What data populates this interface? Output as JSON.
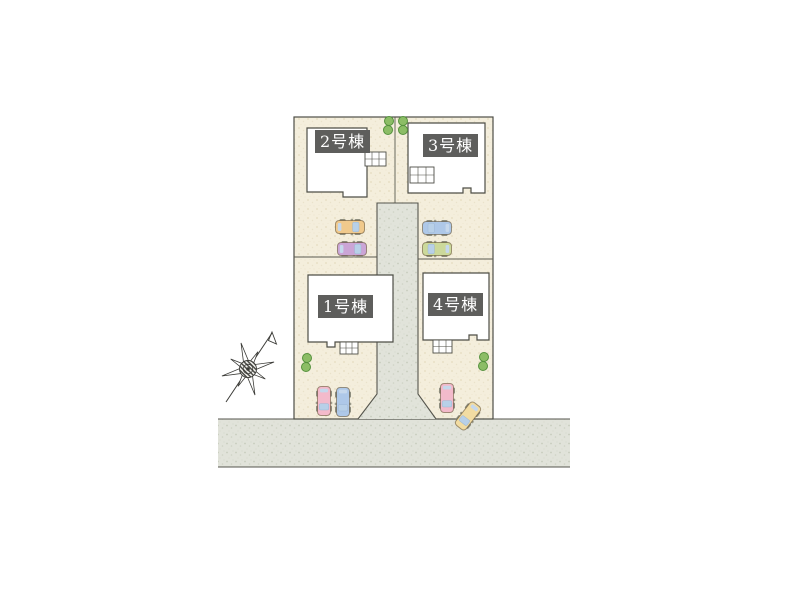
{
  "site_plan": {
    "type": "residential-lot-layout",
    "buildings": [
      {
        "label": "1号棟"
      },
      {
        "label": "2号棟"
      },
      {
        "label": "3号棟"
      },
      {
        "label": "4号棟"
      }
    ],
    "colors": {
      "lot_fill": "#f4eedc",
      "lot_speckle": "#e4dbbf",
      "road_fill": "#e1e3da",
      "road_speckle": "#c7cbbd",
      "outline": "#4e4e46",
      "house_fill": "#ffffff",
      "label_bg": "#5e5e5c",
      "label_text": "#ffffff",
      "bush_fill": "#8cbd66",
      "bush_edge": "#55913d",
      "glass": "#b8d0e8"
    },
    "cars": [
      {
        "name": "car-orange-lot2",
        "color": "#f0c98c"
      },
      {
        "name": "car-purple-lot2",
        "color": "#cba5d6"
      },
      {
        "name": "car-blue-lot3",
        "color": "#aec8e8"
      },
      {
        "name": "car-green-lot3",
        "color": "#ccd99b"
      },
      {
        "name": "car-pink-lot1",
        "color": "#f3bacb"
      },
      {
        "name": "car-blue-lot1",
        "color": "#aec8e8"
      },
      {
        "name": "car-pink-lot4",
        "color": "#f3bacb"
      },
      {
        "name": "car-yellow-lot4",
        "color": "#f2dca2"
      }
    ],
    "features": {
      "compass": "north-arrow-star",
      "bush_pairs": 4,
      "center_driveway": true,
      "front_road": true
    }
  }
}
